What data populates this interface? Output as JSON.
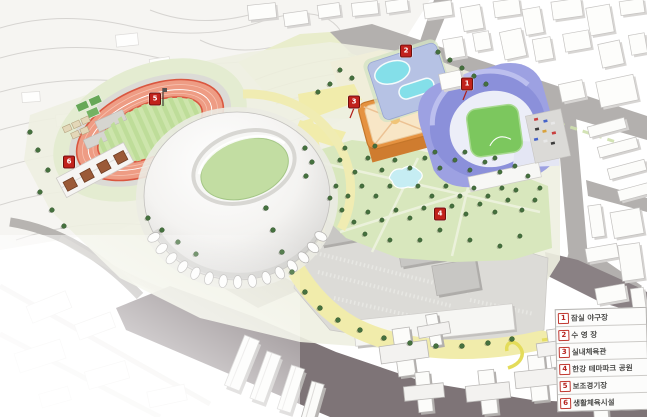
{
  "legend": {
    "rows": [
      {
        "num": "1",
        "label": "잠실 야구장"
      },
      {
        "num": "2",
        "label": "수 영 장"
      },
      {
        "num": "3",
        "label": "실내체육관"
      },
      {
        "num": "4",
        "label": "한강 테마파크 공원"
      },
      {
        "num": "5",
        "label": "보조경기장"
      },
      {
        "num": "6",
        "label": "생활체육시설"
      }
    ]
  },
  "markers": [
    {
      "num": "1",
      "x": 467,
      "y": 84
    },
    {
      "num": "2",
      "x": 406,
      "y": 51
    },
    {
      "num": "3",
      "x": 354,
      "y": 102
    },
    {
      "num": "4",
      "x": 440,
      "y": 214
    },
    {
      "num": "5",
      "x": 155,
      "y": 99
    },
    {
      "num": "6",
      "x": 69,
      "y": 162
    }
  ],
  "colors": {
    "marker_red": "#c1221c",
    "track_red": "#e0573f",
    "infield_green": "#cde5ac",
    "stadium_white": "#f4f3f1",
    "baseball_blue": "#8e93db",
    "ballfield_green": "#7cc75e",
    "pool_cyan": "#84dfe9",
    "pool_deck_blue": "#b6c2e4",
    "arena_orange": "#e59240",
    "park_green": "#d8e7bd",
    "path_yellow": "#f1ecab",
    "road_gray": "#b2afae",
    "road_dark": "#7d7376"
  }
}
